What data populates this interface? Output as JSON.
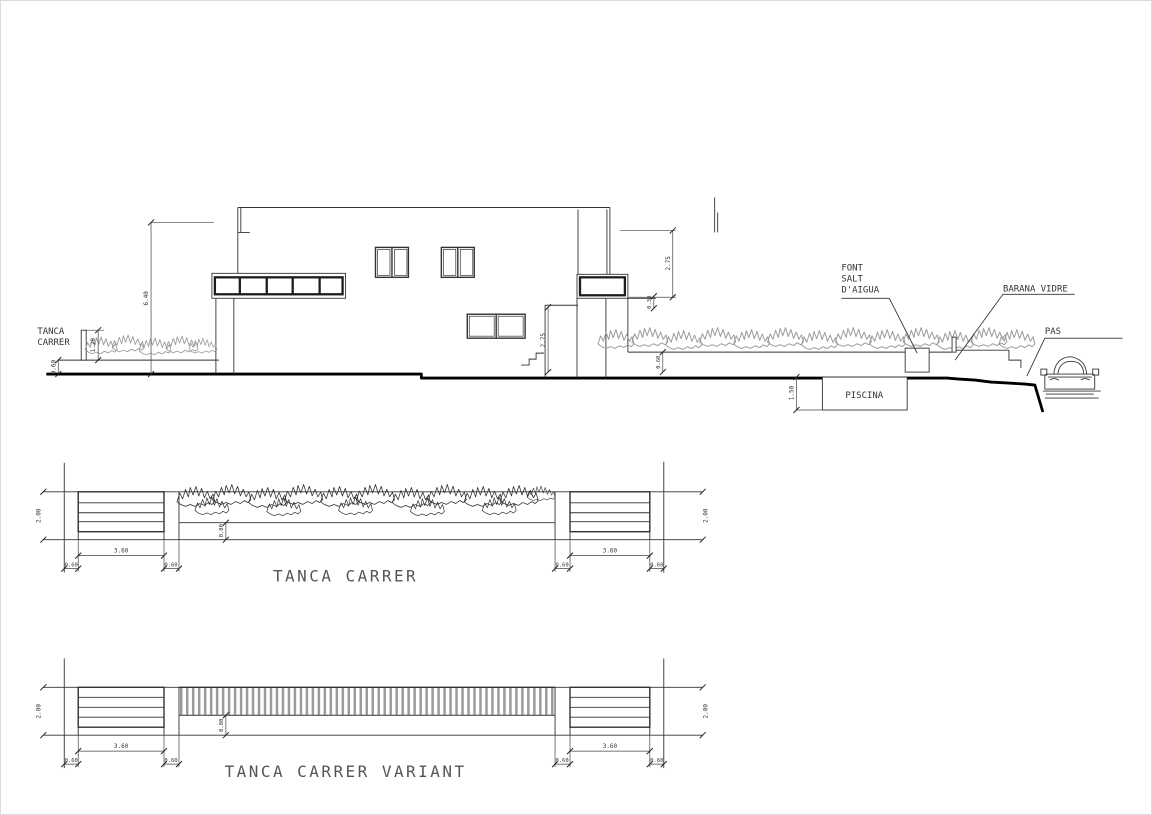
{
  "sheet": {
    "elevation": {
      "labels": {
        "tanca_line1": "TANCA",
        "tanca_line2": "CARRER",
        "font_line1": "FONT",
        "font_line2": "SALT",
        "font_line3": "D'AIGUA",
        "barana": "BARANA VIDRE",
        "pas": "PAS",
        "piscina": "PISCINA"
      },
      "dims": {
        "overall_height": "6.40",
        "fence_body": "1.20",
        "fence_base": "0.60",
        "upper_level": "2.75",
        "slab_edge": "0.30",
        "lower_level": "2.75",
        "pool_depth": "1.50",
        "planter_wall": "0.60"
      }
    },
    "details": [
      {
        "title": "TANCA CARRER",
        "dims": {
          "height": "2.00",
          "panel": "3.60",
          "pillar": "0.60",
          "infill": "0.80"
        }
      },
      {
        "title": "TANCA CARRER VARIANT",
        "dims": {
          "height": "2.00",
          "panel": "3.60",
          "pillar": "0.60",
          "infill": "0.80"
        }
      }
    ]
  }
}
